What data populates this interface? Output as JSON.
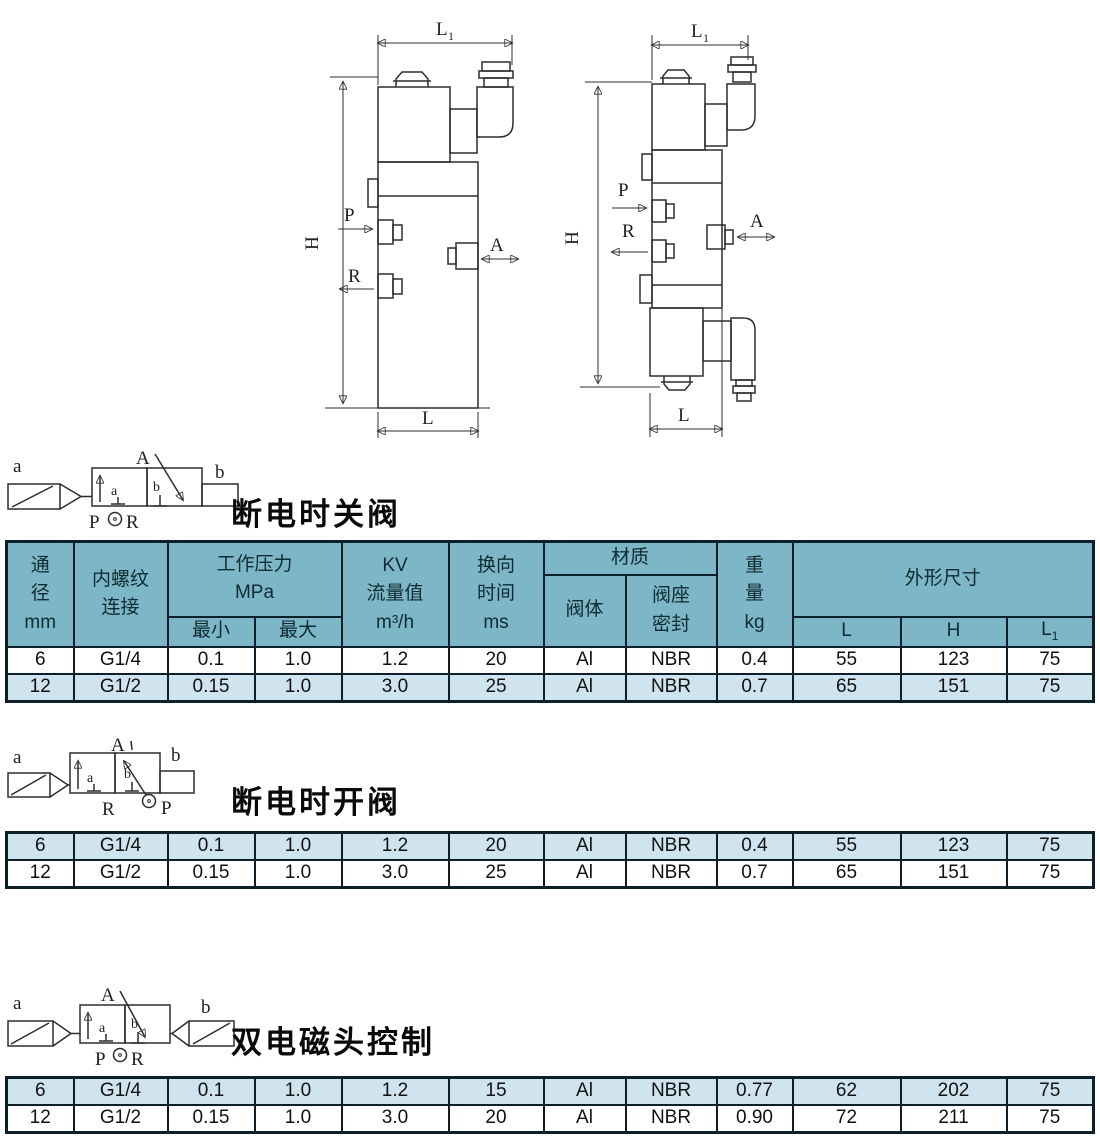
{
  "colors": {
    "header_bg": "#7db6c6",
    "row_alt_bg": "#cfe4ef",
    "border": "#0d1f28",
    "line": "#2d2d2d"
  },
  "drawings": {
    "left": {
      "dim_l1_base": "L",
      "dim_l1_sub": "1",
      "dim_h": "H",
      "port_p": "P",
      "port_r": "R",
      "port_a": "A",
      "dim_l": "L"
    },
    "right": {
      "dim_l1_base": "L",
      "dim_l1_sub": "1",
      "dim_h": "H",
      "port_p": "P",
      "port_r": "R",
      "port_a": "A",
      "dim_l": "L"
    }
  },
  "symbols": [
    {
      "title": "断电时关阀",
      "coil_a": "a",
      "coil_b": "b",
      "port_a_top": "A",
      "port_p": "P",
      "port_r": "R",
      "pos_a": "a",
      "pos_b": "b"
    },
    {
      "title": "断电时开阀",
      "coil_a": "a",
      "coil_b": "b",
      "port_a_top": "A",
      "port_p": "P",
      "port_r": "R",
      "pos_a": "a",
      "pos_b": "b"
    },
    {
      "title": "双电磁头控制",
      "coil_a": "a",
      "coil_b": "b",
      "port_a_top": "A",
      "port_p": "P",
      "port_r": "R",
      "pos_a": "a",
      "pos_b": "b"
    }
  ],
  "table": {
    "header": {
      "bore_l1": "通",
      "bore_l2": "径",
      "bore_unit": "mm",
      "thread_l1": "内螺纹",
      "thread_l2": "连接",
      "pressure_title": "工作压力",
      "pressure_unit": "MPa",
      "pressure_min": "最小",
      "pressure_max": "最大",
      "kv_l1": "KV",
      "kv_l2": "流量值",
      "kv_unit": "m³/h",
      "time_l1": "换向",
      "time_l2": "时间",
      "time_unit": "ms",
      "material_title": "材质",
      "material_body": "阀体",
      "seat_l1": "阀座",
      "seat_l2": "密封",
      "weight_l1": "重",
      "weight_l2": "量",
      "weight_unit": "kg",
      "dims_title": "外形尺寸",
      "dim_L": "L",
      "dim_H": "H",
      "dim_L1_base": "L",
      "dim_L1_sub": "1"
    },
    "t1": {
      "rows": [
        [
          "6",
          "G1/4",
          "0.1",
          "1.0",
          "1.2",
          "20",
          "Al",
          "NBR",
          "0.4",
          "55",
          "123",
          "75"
        ],
        [
          "12",
          "G1/2",
          "0.15",
          "1.0",
          "3.0",
          "25",
          "Al",
          "NBR",
          "0.7",
          "65",
          "151",
          "75"
        ]
      ]
    },
    "t2": {
      "rows": [
        [
          "6",
          "G1/4",
          "0.1",
          "1.0",
          "1.2",
          "20",
          "Al",
          "NBR",
          "0.4",
          "55",
          "123",
          "75"
        ],
        [
          "12",
          "G1/2",
          "0.15",
          "1.0",
          "3.0",
          "25",
          "Al",
          "NBR",
          "0.7",
          "65",
          "151",
          "75"
        ]
      ]
    },
    "t3": {
      "rows": [
        [
          "6",
          "G1/4",
          "0.1",
          "1.0",
          "1.2",
          "15",
          "Al",
          "NBR",
          "0.77",
          "62",
          "202",
          "75"
        ],
        [
          "12",
          "G1/2",
          "0.15",
          "1.0",
          "3.0",
          "20",
          "Al",
          "NBR",
          "0.90",
          "72",
          "211",
          "75"
        ]
      ]
    }
  }
}
